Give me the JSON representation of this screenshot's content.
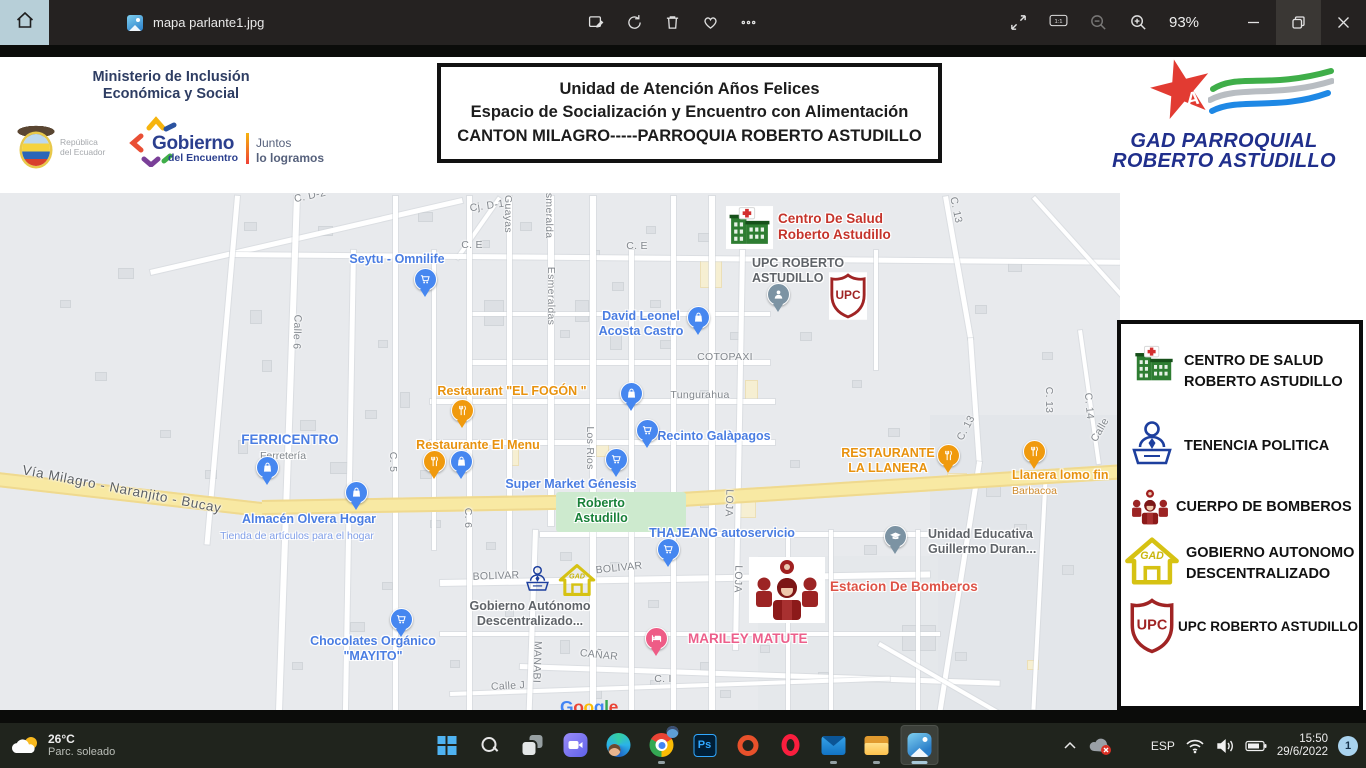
{
  "titlebar": {
    "tab_title": "mapa parlante1.jpg",
    "zoom_level": "93%"
  },
  "glyphs": {
    "ps": "Ps",
    "ratio": "1:1",
    "star": "★",
    "star_a": "A",
    "upc": "UPC",
    "gad": "GAD"
  },
  "header": {
    "ministry_lines": [
      "Ministerio de Inclusión",
      "Económica y Social"
    ],
    "republica_lines": [
      "República",
      "del Ecuador"
    ],
    "gobierno_word": "Gobierno",
    "gobierno_sub": "del Encuentro",
    "slogan_lines": [
      "Juntos",
      "lo logramos"
    ],
    "title_box_lines": [
      "Unidad de Atención Años Felices",
      "Espacio de Socialización y Encuentro con Alimentación",
      "CANTON MILAGRO-----PARROQUIA ROBERTO ASTUDILLO"
    ],
    "gad_logo_lines": [
      "GAD PARROQUIAL",
      "ROBERTO ASTUDILLO"
    ]
  },
  "map": {
    "palette": {
      "blue": "#4a7de2",
      "blue_sub": "#7f9ee8",
      "orange": "#e8920e",
      "orange_sub": "#cf8a2d",
      "red": "#c5342b",
      "red_light": "#dd5246",
      "pink": "#ec5f8b",
      "gray": "#5f6368",
      "gray_sub": "#80868b",
      "green": "#188038",
      "pin_blue": "#4687f0",
      "pin_orange": "#f09a0e",
      "pin_pink": "#ee5c86",
      "pin_gray": "#7c93a3"
    },
    "street_labels": [
      {
        "text": "C. D-2",
        "x": 310,
        "y": 196,
        "rot": -12
      },
      {
        "text": "Cj. D-1",
        "x": 487,
        "y": 206,
        "rot": -8
      },
      {
        "text": "C. E",
        "x": 472,
        "y": 245,
        "rot": 0
      },
      {
        "text": "C. E",
        "x": 637,
        "y": 246,
        "rot": 0
      },
      {
        "text": "Guayas",
        "x": 508,
        "y": 214,
        "rot": 90
      },
      {
        "text": "Esmeralda",
        "x": 549,
        "y": 212,
        "rot": 90
      },
      {
        "text": "Esmeraldas",
        "x": 551,
        "y": 296,
        "rot": 90
      },
      {
        "text": "Los Rios",
        "x": 590,
        "y": 448,
        "rot": 90
      },
      {
        "text": "Calle 6",
        "x": 297,
        "y": 332,
        "rot": 92
      },
      {
        "text": "C. 5",
        "x": 393,
        "y": 462,
        "rot": 90
      },
      {
        "text": "C. 6",
        "x": 468,
        "y": 518,
        "rot": 90
      },
      {
        "text": "COTOPAXI",
        "x": 725,
        "y": 357,
        "rot": 0
      },
      {
        "text": "Tungurahua",
        "x": 700,
        "y": 395,
        "rot": 0
      },
      {
        "text": "LOJA",
        "x": 729,
        "y": 503,
        "rot": 92
      },
      {
        "text": "LOJA",
        "x": 738,
        "y": 579,
        "rot": 92
      },
      {
        "text": "BOLIVAR",
        "x": 496,
        "y": 576,
        "rot": -2
      },
      {
        "text": "BOLIVAR",
        "x": 619,
        "y": 568,
        "rot": -6
      },
      {
        "text": "MANABI",
        "x": 537,
        "y": 662,
        "rot": 92
      },
      {
        "text": "CAÑAR",
        "x": 599,
        "y": 655,
        "rot": 6
      },
      {
        "text": "Calle J",
        "x": 508,
        "y": 686,
        "rot": -3
      },
      {
        "text": "C. I",
        "x": 663,
        "y": 679,
        "rot": 0
      },
      {
        "text": "C. 13",
        "x": 956,
        "y": 210,
        "rot": 78
      },
      {
        "text": "C. 13",
        "x": 966,
        "y": 428,
        "rot": -62
      },
      {
        "text": "C. 13",
        "x": 1049,
        "y": 400,
        "rot": 90
      },
      {
        "text": "C. 14",
        "x": 1089,
        "y": 406,
        "rot": 85
      },
      {
        "text": "Calle",
        "x": 1100,
        "y": 430,
        "rot": -60
      },
      {
        "text": "Vía Milagro - Naranjito - Bucay",
        "x": 122,
        "y": 489,
        "rot": 11,
        "road": true
      }
    ],
    "places": [
      {
        "lines": [
          "Seytu - Omnilife"
        ],
        "x": 397,
        "y": 252,
        "color": "blue",
        "align": "center",
        "size": "md"
      },
      {
        "lines": [
          "Centro De Salud",
          "Roberto Astudillo"
        ],
        "x": 778,
        "y": 211,
        "color": "red",
        "align": "left",
        "size": "lg"
      },
      {
        "lines": [
          "UPC ROBERTO",
          "ASTUDILLO"
        ],
        "x": 752,
        "y": 256,
        "color": "gray",
        "align": "left",
        "size": "md"
      },
      {
        "lines": [
          "David Leonel",
          "Acosta Castro"
        ],
        "x": 641,
        "y": 309,
        "color": "blue",
        "align": "center",
        "size": "md"
      },
      {
        "lines": [
          "Restaurant \"EL FOGÓN \""
        ],
        "x": 512,
        "y": 384,
        "color": "orange",
        "align": "center",
        "size": "md"
      },
      {
        "lines": [
          "Restaurante El Menu"
        ],
        "x": 478,
        "y": 438,
        "color": "orange",
        "align": "center",
        "size": "md"
      },
      {
        "lines": [
          "FERRICENTRO"
        ],
        "x": 290,
        "y": 432,
        "color": "blue",
        "align": "center",
        "size": "lg"
      },
      {
        "lines": [
          "Ferretería"
        ],
        "x": 283,
        "y": 450,
        "color": "gray_sub",
        "align": "center",
        "size": "sm"
      },
      {
        "lines": [
          "Recinto Galàpagos"
        ],
        "x": 714,
        "y": 429,
        "color": "blue",
        "align": "center",
        "size": "md"
      },
      {
        "lines": [
          "Super Market Génesis"
        ],
        "x": 571,
        "y": 477,
        "color": "blue",
        "align": "center",
        "size": "md"
      },
      {
        "lines": [
          "Roberto",
          "Astudillo"
        ],
        "x": 601,
        "y": 496,
        "color": "green",
        "align": "center",
        "size": "md"
      },
      {
        "lines": [
          "Almacén Olvera Hogar"
        ],
        "x": 309,
        "y": 512,
        "color": "blue",
        "align": "center",
        "size": "md"
      },
      {
        "lines": [
          "Tienda de artículos para el hogar"
        ],
        "x": 297,
        "y": 530,
        "color": "blue_sub",
        "align": "center",
        "size": "sm"
      },
      {
        "lines": [
          "RESTAURANTE",
          "LA LLANERA"
        ],
        "x": 888,
        "y": 446,
        "color": "orange",
        "align": "center",
        "size": "md"
      },
      {
        "lines": [
          "Llanera lomo fin"
        ],
        "x": 1012,
        "y": 468,
        "color": "orange",
        "align": "left",
        "size": "md"
      },
      {
        "lines": [
          "Barbacoa"
        ],
        "x": 1012,
        "y": 485,
        "color": "orange_sub",
        "align": "left",
        "size": "sm"
      },
      {
        "lines": [
          "Unidad Educativa",
          "Guillermo Duran..."
        ],
        "x": 928,
        "y": 527,
        "color": "gray",
        "align": "left",
        "size": "md"
      },
      {
        "lines": [
          "THAJEANG autoservicio"
        ],
        "x": 722,
        "y": 526,
        "color": "blue",
        "align": "center",
        "size": "md"
      },
      {
        "lines": [
          "Estacion De Bomberos"
        ],
        "x": 830,
        "y": 579,
        "color": "red_light",
        "align": "left",
        "size": "lg"
      },
      {
        "lines": [
          "MARILEY MATUTE"
        ],
        "x": 688,
        "y": 631,
        "color": "pink",
        "align": "left",
        "size": "lg"
      },
      {
        "lines": [
          "Gobierno Autónomo",
          "Descentralizado..."
        ],
        "x": 530,
        "y": 599,
        "color": "gray",
        "align": "center",
        "size": "md"
      },
      {
        "lines": [
          "Chocolates Orgánico",
          "\"MAYITO\""
        ],
        "x": 373,
        "y": 634,
        "color": "blue",
        "align": "center",
        "size": "md"
      }
    ],
    "pins": [
      {
        "type": "cart",
        "x": 425,
        "y": 279
      },
      {
        "type": "bag",
        "x": 698,
        "y": 317
      },
      {
        "type": "bag",
        "x": 631,
        "y": 393
      },
      {
        "type": "cart",
        "x": 647,
        "y": 430
      },
      {
        "type": "cart",
        "x": 616,
        "y": 459
      },
      {
        "type": "food",
        "x": 462,
        "y": 410
      },
      {
        "type": "food",
        "x": 434,
        "y": 461
      },
      {
        "type": "bag",
        "x": 461,
        "y": 461
      },
      {
        "type": "bag",
        "x": 267,
        "y": 467
      },
      {
        "type": "bag",
        "x": 356,
        "y": 492
      },
      {
        "type": "cart",
        "x": 668,
        "y": 549
      },
      {
        "type": "cart",
        "x": 401,
        "y": 619
      },
      {
        "type": "food",
        "x": 948,
        "y": 455
      },
      {
        "type": "food",
        "x": 1034,
        "y": 451
      },
      {
        "type": "grad",
        "x": 895,
        "y": 536
      },
      {
        "type": "bed",
        "x": 656,
        "y": 638
      },
      {
        "type": "person",
        "x": 778,
        "y": 294
      }
    ],
    "markers": [
      {
        "icon": "hospital",
        "x": 726,
        "y": 206,
        "w": 47,
        "h": 43
      },
      {
        "icon": "upc-shield",
        "x": 829,
        "y": 272,
        "w": 38,
        "h": 48
      },
      {
        "icon": "tenencia",
        "x": 524,
        "y": 564,
        "w": 27,
        "h": 30
      },
      {
        "icon": "gad-house",
        "x": 558,
        "y": 562,
        "w": 38,
        "h": 36
      },
      {
        "icon": "firefighters",
        "x": 748,
        "y": 557,
        "w": 78,
        "h": 66
      }
    ],
    "watermark": "Google"
  },
  "legend": {
    "items": [
      {
        "icon": "hospital",
        "ix": 11,
        "iy": 20,
        "iw": 44,
        "ih": 42,
        "tx": 63,
        "ty": 27,
        "fs": 14.5,
        "lines": [
          "CENTRO DE SALUD",
          "ROBERTO ASTUDILLO"
        ]
      },
      {
        "icon": "tenencia",
        "ix": 8,
        "iy": 94,
        "iw": 46,
        "ih": 52,
        "tx": 63,
        "ty": 112,
        "fs": 14.5,
        "lines": [
          "TENENCIA POLITICA"
        ]
      },
      {
        "icon": "firefighters",
        "ix": 7,
        "iy": 163,
        "iw": 44,
        "ih": 40,
        "tx": 55,
        "ty": 173,
        "fs": 14.5,
        "lines": [
          "CUERPO DE BOMBEROS"
        ]
      },
      {
        "icon": "gad-house",
        "ix": 3,
        "iy": 209,
        "iw": 56,
        "ih": 56,
        "tx": 65,
        "ty": 219,
        "fs": 14.5,
        "lines": [
          "GOBIERNO AUTONOMO",
          "DESCENTRALIZADO"
        ]
      },
      {
        "icon": "upc-shield",
        "ix": 7,
        "iy": 273,
        "iw": 48,
        "ih": 58,
        "tx": 57,
        "ty": 292,
        "fs": 13.5,
        "lines": [
          "UPC ROBERTO ASTUDILLO"
        ]
      }
    ]
  },
  "taskbar": {
    "weather_temp": "26°C",
    "weather_cond": "Parc. soleado",
    "tray_lang": "ESP",
    "tray_time": "15:50",
    "tray_date": "29/6/2022",
    "badge_count": "1"
  }
}
